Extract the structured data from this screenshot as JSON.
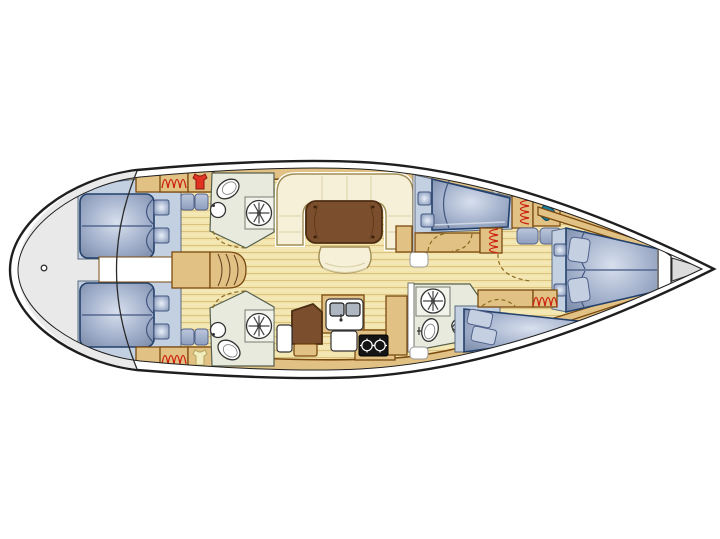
{
  "diagram": {
    "type": "yacht-floor-plan",
    "orientation": "bow-right",
    "rooms": [
      "aft-cabin-port",
      "aft-cabin-starboard",
      "aft-head-port",
      "aft-head-starboard",
      "companionway",
      "salon",
      "galley",
      "nav-station",
      "mid-cabin-port",
      "mid-cabin-starboard",
      "forward-head",
      "forward-cabin"
    ],
    "fixtures": [
      "double-berth",
      "double-berth",
      "v-berth",
      "single-berth",
      "single-berth",
      "toilet",
      "toilet",
      "toilet",
      "shower",
      "shower",
      "shower",
      "washbasin",
      "washbasin",
      "washbasin",
      "galley-double-sink",
      "stove-two-burner",
      "salon-table",
      "u-settee",
      "stool",
      "chart-table",
      "companionway-steps",
      "hanging-locker",
      "hanging-locker",
      "hanging-locker",
      "hanging-locker",
      "hanging-locker",
      "life-vest",
      "life-vest",
      "swim-platform"
    ]
  },
  "colors": {
    "hull_outline": "#1f1f1f",
    "hull_fill": "#ffffff",
    "stern_platform": "#e9e9e9",
    "trim_wood": "#e2c184",
    "trim_border": "#7a4a10",
    "floor_wood": "#f3e5ae",
    "floor_plank_line": "#d9c07a",
    "cabin_floor_blue": "#c2d0e2",
    "berth_border": "#23406b",
    "pillow": "#c4cfe2",
    "head_floor": "#e7eadd",
    "settee_cream": "#f6f0d8",
    "settee_border": "#a08d55",
    "table_brown": "#7b4f2e",
    "table_border": "#4c2d11",
    "stove_black": "#141414",
    "sink_gray": "#aeb6c2",
    "hanger_red": "#cc2211",
    "vest_red": "#e03322",
    "vest_yellow": "#f2ecbe",
    "teal_item": "#1b7e9e",
    "door_dash": "#8a6a20",
    "fixture_white": "#ffffff",
    "fixture_border": "#333333"
  }
}
